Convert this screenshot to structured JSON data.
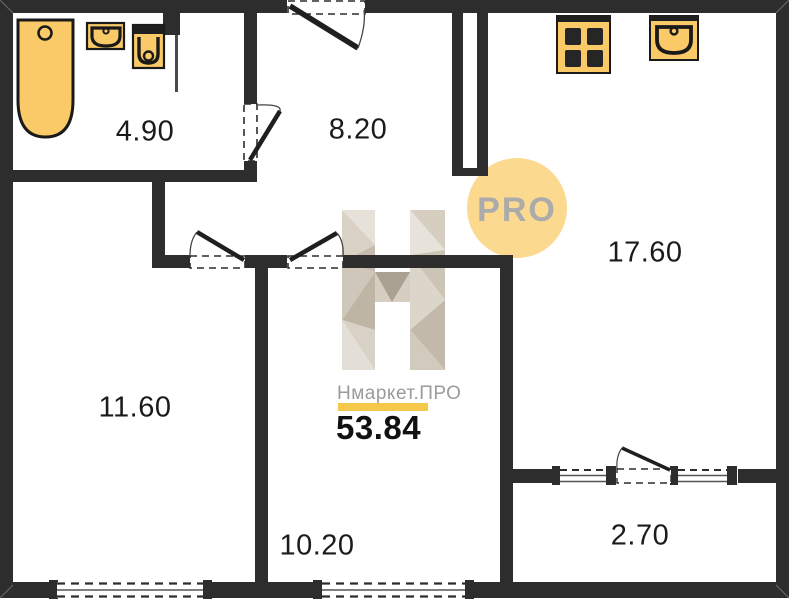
{
  "watermark": {
    "badge_label": "PRO",
    "brand_text": "Нмаркет.ПРО",
    "total_area": "53.84",
    "badge_color": "#FBD98E",
    "badge_text_color": "#ABABAB",
    "underline_color": "#F5C84C",
    "logo": "faceted-h-logo"
  },
  "plan": {
    "type": "apartment-floor-plan",
    "wall_color": "#2d2d2d",
    "fixture_color": "#F9CA67",
    "rooms": [
      {
        "id": "bathroom",
        "area": "4.90"
      },
      {
        "id": "hallway",
        "area": "8.20"
      },
      {
        "id": "kitchen-living-room",
        "area": "17.60"
      },
      {
        "id": "bedroom",
        "area": "11.60"
      },
      {
        "id": "room",
        "area": "10.20"
      },
      {
        "id": "balcony",
        "area": "2.70"
      }
    ],
    "fixtures": [
      "bathtub-icon",
      "bathroom-sink-icon",
      "toilet-icon",
      "stove-icon",
      "kitchen-sink-icon"
    ],
    "doors": [
      "entrance-door",
      "bathroom-door",
      "bedroom-door",
      "room-door",
      "balcony-door"
    ],
    "windows": [
      "bedroom-window",
      "room-window",
      "balcony-window-left",
      "balcony-window-right"
    ]
  }
}
